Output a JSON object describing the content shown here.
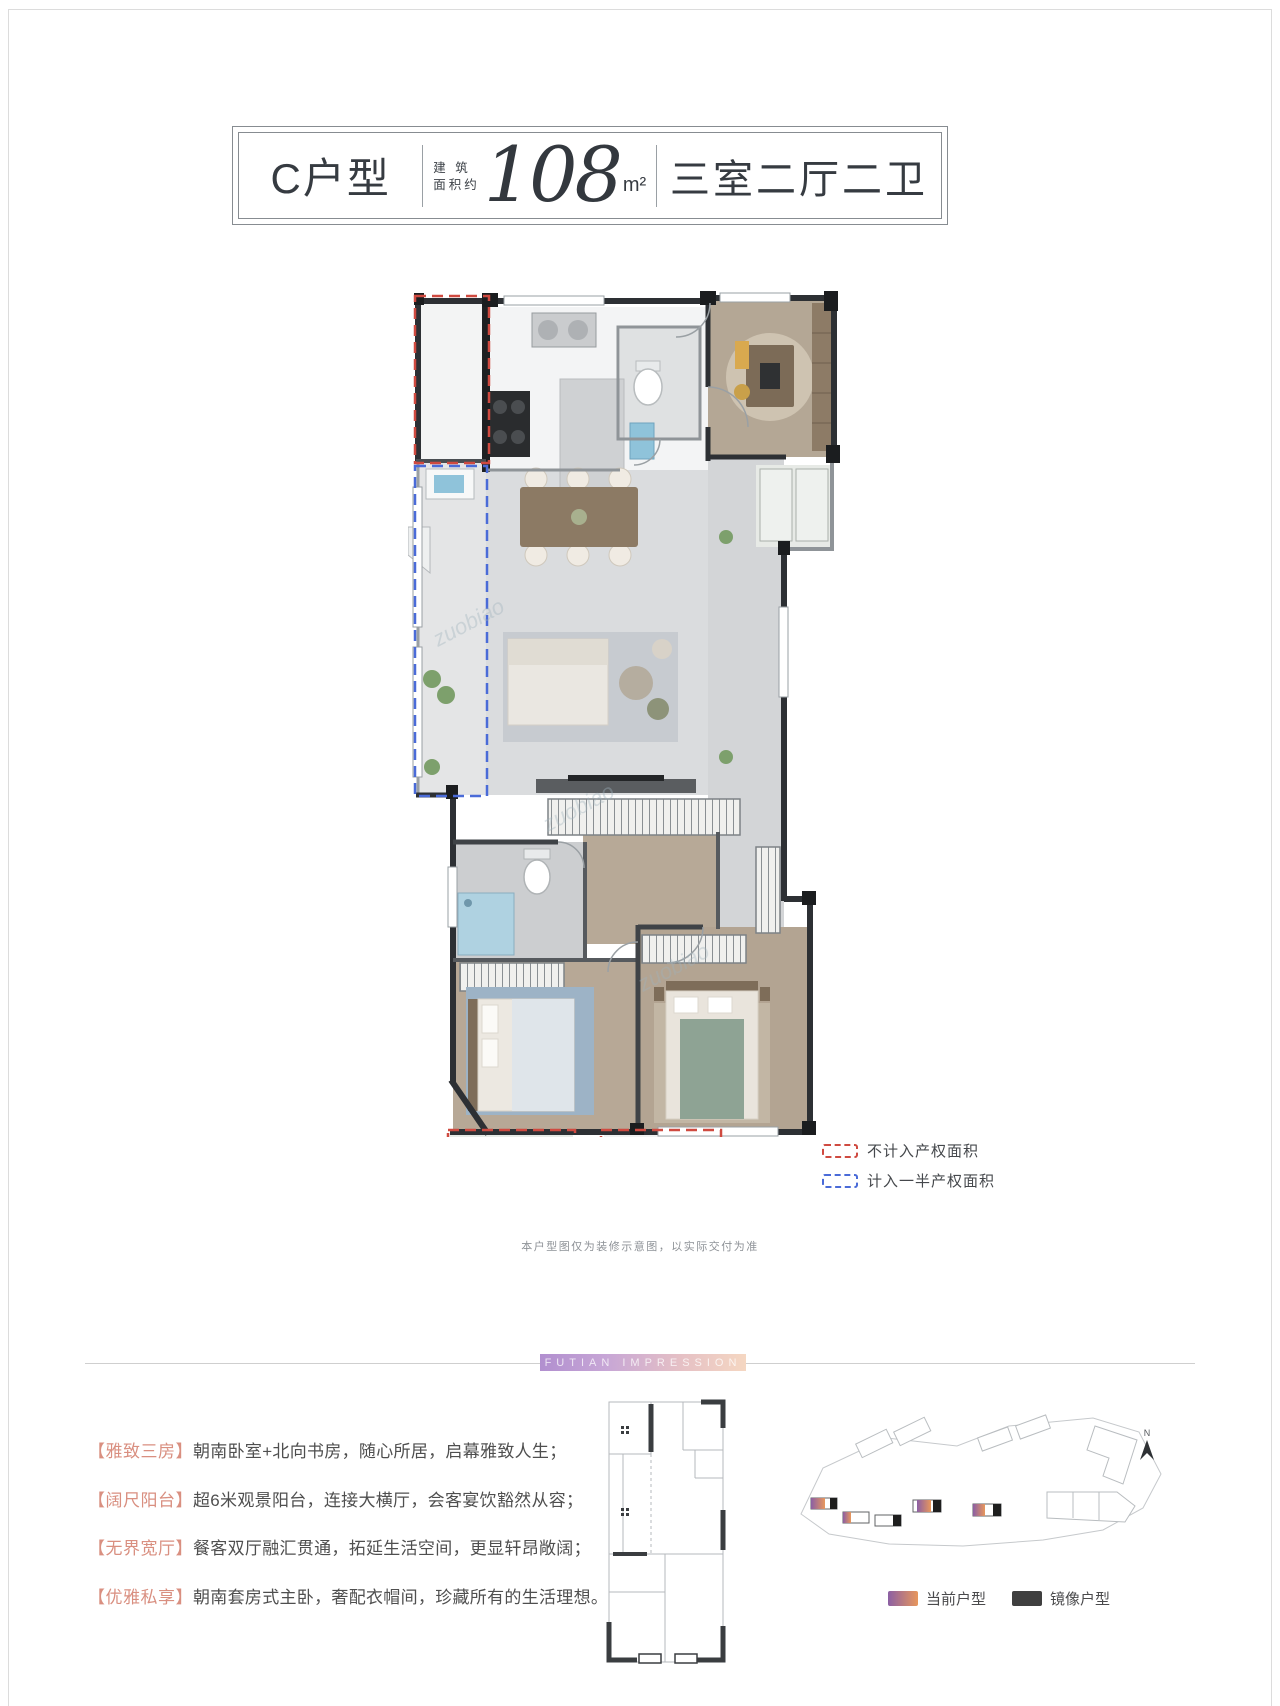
{
  "header": {
    "unit": "C户型",
    "area_label_line1": "建 筑",
    "area_label_line2": "面积约",
    "area_value": "108",
    "area_unit": "m²",
    "layout": "三室二厅二卫"
  },
  "plan_legend": {
    "red_label": "不计入产权面积",
    "blue_label": "计入一半产权面积",
    "red_color": "#cf4a40",
    "blue_color": "#4a6bd8"
  },
  "disclaimer": "本户型图仅为装修示意图，以实际交付为准",
  "watermark": "zuobiao",
  "banner_title": "FUTIAN IMPRESSION",
  "features": [
    {
      "tag": "【雅致三房】",
      "desc": "朝南卧室+北向书房，随心所居，启幕雅致人生；"
    },
    {
      "tag": "【阔尺阳台】",
      "desc": "超6米观景阳台，连接大横厅，会客宴饮豁然从容；"
    },
    {
      "tag": "【无界宽厅】",
      "desc": "餐客双厅融汇贯通，拓延生活空间，更显轩昂敞阔；"
    },
    {
      "tag": "【优雅私享】",
      "desc": "朝南套房式主卧，奢配衣帽间，珍藏所有的生活理想。"
    }
  ],
  "siteplan": {
    "north": "N",
    "legend_current": "当前户型",
    "legend_mirror": "镜像户型",
    "gradient_from": "#8b5fa4",
    "gradient_to": "#e8975c",
    "mirror_color": "#3f3f3f"
  }
}
